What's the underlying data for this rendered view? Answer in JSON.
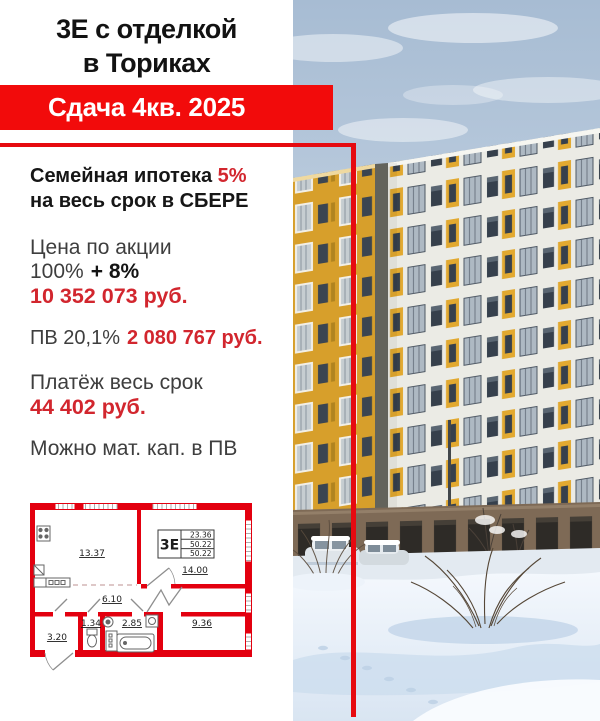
{
  "colors": {
    "banner_red": "#F20B0B",
    "frame_red": "#E60A10",
    "text_red": "#D2262E",
    "plan_red": "#E3000F",
    "building_yellow": "#D79F2B",
    "facade_white": "#EBEBE5"
  },
  "header": {
    "title_line1": "3Е с отделкой",
    "title_line2": "в Ториках",
    "banner": "Сдача 4кв. 2025"
  },
  "offer": {
    "family_mortgage_text": "Семейная ипотека",
    "family_mortgage_rate": "5%",
    "family_mortgage_line2": "на весь срок в СБЕРЕ",
    "price_label": "Цена по акции",
    "price_base": "100%",
    "price_bonus": "+ 8%",
    "price_value": "10 352 073 руб.",
    "pv_label": "ПВ 20,1%",
    "pv_value": "2 080 767 руб.",
    "payment_label": "Платёж весь срок",
    "payment_value": "44 402 руб.",
    "matcap": "Можно мат. кап. в ПВ"
  },
  "floorplan": {
    "type_label": "3Е",
    "area_rows": [
      "23.36",
      "50.22",
      "50.22"
    ],
    "rooms": [
      {
        "name": "kitchen-living",
        "area": "13.37"
      },
      {
        "name": "bedroom-1",
        "area": "14.00"
      },
      {
        "name": "hallway",
        "area": "6.10"
      },
      {
        "name": "wc",
        "area": "1.34"
      },
      {
        "name": "bathroom",
        "area": "2.85"
      },
      {
        "name": "entry",
        "area": "3.20"
      },
      {
        "name": "bedroom-2",
        "area": "9.36"
      }
    ]
  }
}
